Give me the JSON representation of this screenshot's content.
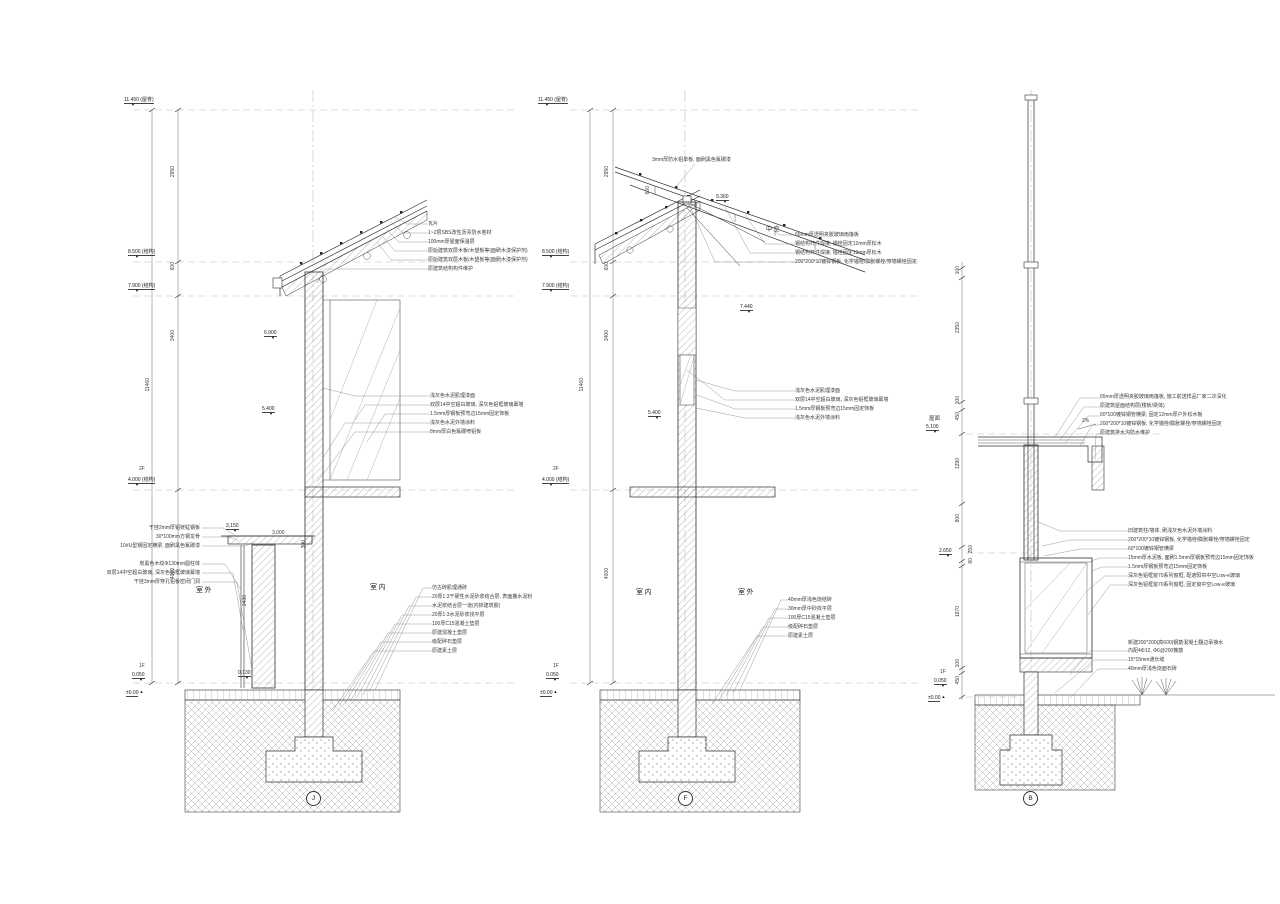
{
  "glyphs": {
    "marker_down": "▼",
    "marker_up": "▲"
  },
  "sectionJ": {
    "tag": "J",
    "levels": {
      "ridge": "11.450 (屋脊)",
      "e8500": "8.500 (结构)",
      "e7900": "7.900 (结构)",
      "floor2": "2F",
      "e4000": "4.000 (结构)",
      "floor1": "1F",
      "e0050": "0.050",
      "zero": "±0.00",
      "e6900": "6.900",
      "e5400": "5.400",
      "e0130": "0.130",
      "h3150": "3,150"
    },
    "dims": {
      "v2950": "2950",
      "v600": "600",
      "v3400": "3400",
      "v11460": "11460",
      "v4000": "4000",
      "h3000": "3,000",
      "v300": "300",
      "v2430": "2430"
    },
    "rooms": {
      "outdoor": "室外",
      "indoor": "室内"
    },
    "roof_notes": [
      "瓦片",
      "1~2层SBS改性沥青防水卷材",
      "100mm厚屋面保温层",
      "原始建筑双层木板/木望板等(面刷木漆保护剂)",
      "原始建筑双层木板/木望板等(面刷木漆保护剂)",
      "原建筑结构构件维护"
    ],
    "wall_notes": [
      "浅灰色水泥肌理漆面",
      "双层14中空超白玻璃, 深灰色铝框玻璃幕墙",
      "1.5mm厚钢板预弯边15mm固定饰板",
      "浅灰色水泥外墙涂料",
      "8mm厚白色氟碳喷铝板"
    ],
    "left_notes": [
      "干挂2mm厚铝镁锰钢板",
      "30*100mm方钢龙骨",
      "10#U型钢固定横梁, 面刷黑色氟碳漆",
      "炭黑色木纹Φ130mm圆柱体",
      "双层14中空超白玻璃, 深灰色铝框玻璃幕墙",
      "干挂3mm厚穿孔铝板密闭门洞"
    ],
    "floor_notes": [
      "仿古砖肌理通砖",
      "20厚1:3干硬性水泥砂浆结合层, 表面撒水泥粉",
      "水泥浆结合层一道(内掺建筑胶)",
      "20厚1:3水泥砂浆找平层",
      "100厚C15混凝土垫层",
      "原建混凝土垫层",
      "级配碎石垫层",
      "原建素土层"
    ]
  },
  "sectionF": {
    "tag": "F",
    "levels": {
      "ridge": "11.450 (屋脊)",
      "e8500": "8.500 (结构)",
      "e7900": "7.900 (结构)",
      "floor2": "2F",
      "e4000": "4.000 (结构)",
      "floor1": "1F",
      "e0050": "0.050",
      "zero": "±0.00",
      "e9360": "9.360",
      "e7440": "7.440",
      "e5400": "5.400"
    },
    "dims": {
      "v2950": "2950",
      "v600": "600",
      "v3400": "3400",
      "v11460": "11460",
      "v4000": "4000",
      "v600roof": "600"
    },
    "void_label": "中空",
    "top_note": "3mm厚防水铝单板, 面刷黑色氟碳漆",
    "right_notes": [
      "65mm厚透明夹胶玻璃雨篷板",
      "钢结构杆件焊接, 锚栓固定12mm厚松木",
      "钢结构杆件焊接, 锚栓固定13mm厚松木",
      "200*200*10镀锌钢板, 化学锚栓/膨胀螺栓/穿墙螺栓固定"
    ],
    "wall_notes": [
      "浅灰色水泥肌理漆面",
      "双层14中空超白玻璃, 深灰色铝框玻璃幕墙",
      "1.5mm厚钢板预弯边15mm固定饰板",
      "浅灰色水泥外墙涂料"
    ],
    "rooms": {
      "indoor": "室内",
      "outdoor": "室外"
    },
    "floor_notes": [
      "40mm厚浅色烧结砖",
      "30mm厚中砂找平层",
      "100厚C15混凝土垫层",
      "级配碎石垫层",
      "原建素土层"
    ]
  },
  "sectionB": {
    "tag": "B",
    "levels": {
      "roof_label": "屋面",
      "e5100": "5.100",
      "e2650": "2.650",
      "floor1": "1F",
      "e0050": "0.050",
      "zero": "±0.00"
    },
    "dims": {
      "v100a": "100",
      "v2350": "2350",
      "v100b": "100",
      "v450a": "450",
      "v1290": "1290",
      "v800": "800",
      "v250": "250",
      "v80": "80",
      "v1970": "1970",
      "v100c": "100",
      "v450b": "450",
      "slope": "2%"
    },
    "top_notes": [
      "65mm厚透明夹胶玻璃雨篷板, 施工前送样品厂家二次深化",
      "原建筑屋面结构层(楼板/梁体)",
      "60*100镀锌钢管横梁, 固定12mm厚户外松木板",
      "200*200*10镀锌钢板, 化学锚栓/膨胀螺栓/穿墙螺栓固定",
      "原建筑排水沟防水维护"
    ],
    "mid_notes": [
      "旧建筑柱/墙体, 刷浅灰色水泥外墙涂料",
      "200*200*10镀锌钢板, 化学锚栓/膨胀螺栓/穿墙螺栓固定",
      "60*100镀锌钢管横梁",
      "15mm厚水泥板, 面刷1.5mm厚钢板预弯边15mm固定饰板",
      "1.5mm厚钢板预弯边15mm固定饰板",
      "深灰色铝框窗70系列窗框, 配遮阳帘中空Low-e玻璃",
      "深灰色铝框窗70系列窗框, 固定窗中空Low-e玻璃"
    ],
    "bottom_notes": [
      "新建200*200(高600)钢筋混凝土翻边承接水",
      "内配4Φ12, Φ6@200箍筋",
      "15*15mm通长缝",
      "40mm厚浅色烧面石砖"
    ]
  }
}
